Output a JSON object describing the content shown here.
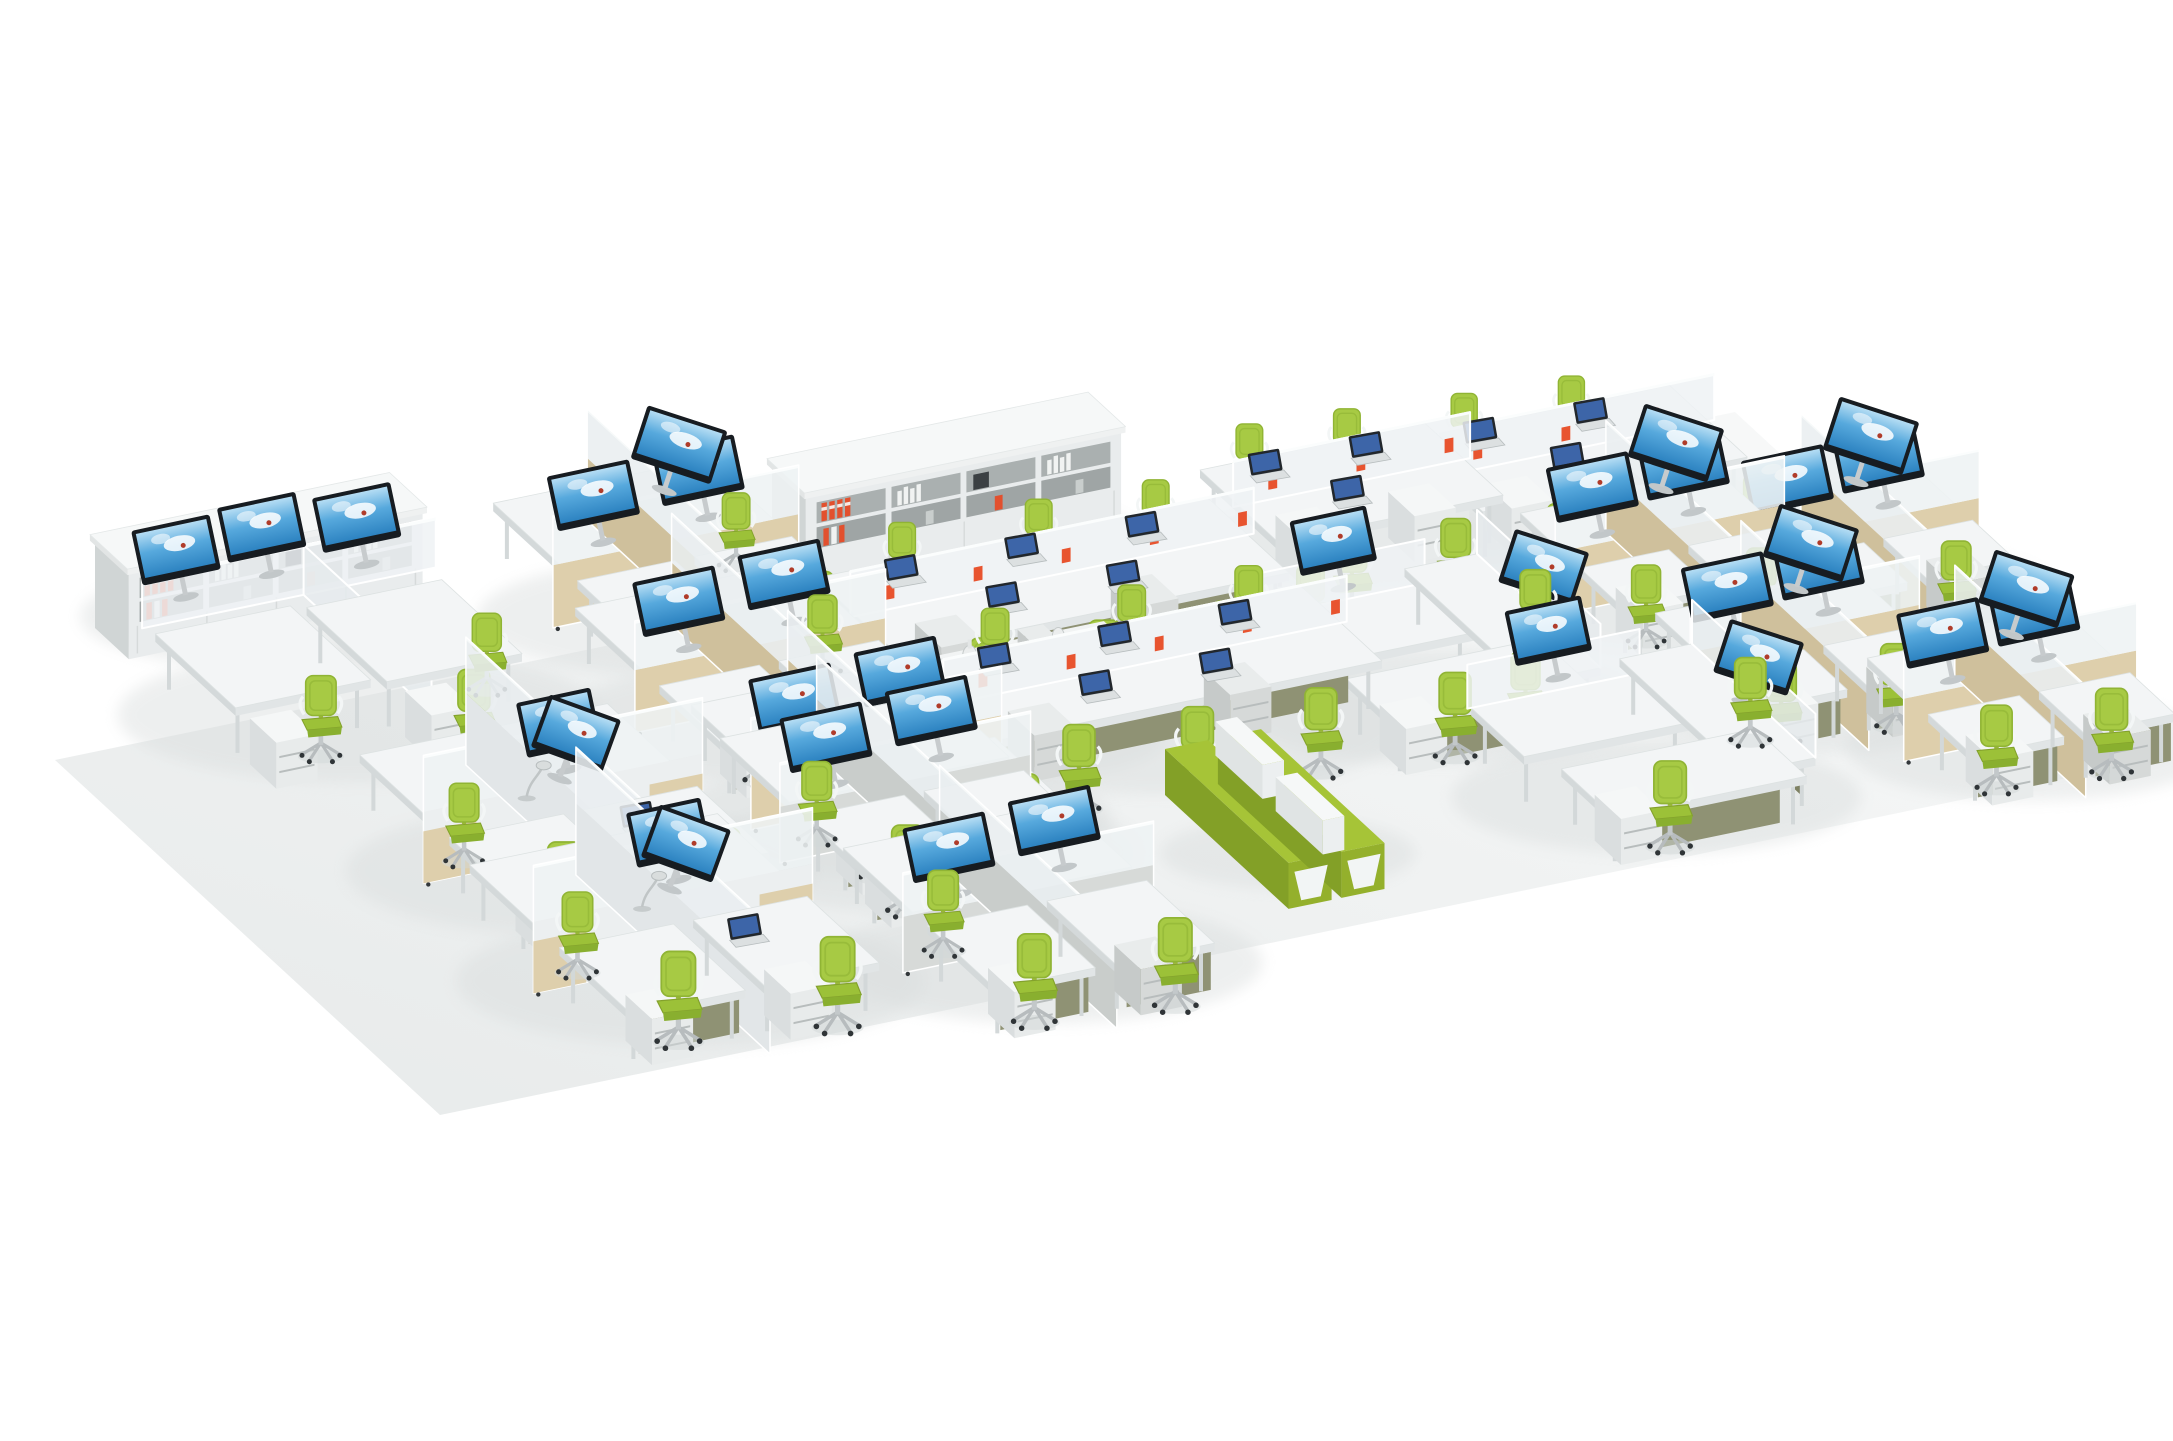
{
  "meta": {
    "title": "Open plan office furniture layout — isometric product render",
    "scene_type": "3d-furniture-render",
    "visible_text": ""
  },
  "palette": {
    "background": "#ffffff",
    "floor_light": "#f9fafa",
    "floor_dark": "#e7eaea",
    "shadow": "#d9dddd",
    "desk_top": "#f3f5f6",
    "desk_front": "#e1e5e6",
    "desk_side": "#d4d9da",
    "panel_frost": "#eef2f4",
    "panel_tan": "#decfac",
    "panel_tan_dark": "#cfc09c",
    "panel_concrete": "#d7dad8",
    "modesty_khaki": "#8f9274",
    "chair_green": "#a7ca44",
    "chair_green_dark": "#88ae2e",
    "monitor_bezel": "#171c21",
    "screen_sky_top": "#b5ddf4",
    "screen_sky_mid": "#57a9dd",
    "screen_sky_bottom": "#2d83c1",
    "binder_red": "#e2502e",
    "accent_orange": "#e8542f",
    "bench_green": "#a6c437"
  },
  "scene": {
    "floor": {
      "corners": [
        [
          55,
          760
        ],
        [
          1735,
          412
        ],
        [
          2120,
          767
        ],
        [
          440,
          1115
        ]
      ],
      "gradient": [
        "#f9fafa",
        "#e7eaea"
      ]
    },
    "axes": {
      "u": [
        0.9792,
        -0.2028
      ],
      "v": [
        0.7352,
        0.6779
      ]
    },
    "items": [
      {
        "id": "wall-shelf-left",
        "type": "shelf",
        "label": "bookcase wall with red binders",
        "anchor": [
          95,
          628
        ],
        "lu": 300,
        "lv": 46,
        "h": 92,
        "segments": 4
      },
      {
        "id": "corner-workstations-left",
        "type": "cornerquad",
        "label": "corner workstation pod with monitors",
        "anchor": [
          120,
          660
        ],
        "lu": 300,
        "lv": 210,
        "chairs": [
          [
            85,
            160,
            1.05
          ],
          [
            215,
            195,
            1.1
          ],
          [
            283,
            122,
            1.0
          ]
        ],
        "monitors": [
          [
            58,
            34,
            -12,
            94
          ],
          [
            150,
            28,
            -12,
            94
          ],
          [
            238,
            40,
            -12,
            94
          ]
        ]
      },
      {
        "id": "workstation-quad-a",
        "type": "quad",
        "variant": "tan",
        "label": "4-person cubicle cluster",
        "anchor": [
          478,
          550
        ],
        "lu": 235,
        "lv": 225,
        "chairs": [
          [
            62,
            192,
            1.05
          ],
          [
            192,
            206,
            1.1
          ],
          [
            205,
            78,
            0.95
          ]
        ],
        "monitors": [
          [
            56,
            118,
            -12,
            96
          ],
          [
            166,
            114,
            -12,
            96
          ],
          [
            122,
            58,
            18,
            96
          ]
        ]
      },
      {
        "id": "wall-shelf-center",
        "type": "shelf",
        "label": "bookcase wall with red binders",
        "anchor": [
          772,
          556
        ],
        "lu": 322,
        "lv": 46,
        "h": 96,
        "segments": 4
      },
      {
        "id": "bench-row-1",
        "type": "bench",
        "variant": "khaki",
        "label": "shared bench desk row with laptops",
        "anchor": [
          815,
          630
        ],
        "lu": 400,
        "lv": 112,
        "chairs": [
          [
            110,
            -28,
            0.92
          ],
          [
            245,
            -22,
            0.92
          ],
          [
            360,
            -16,
            0.92
          ],
          [
            65,
            146,
            1.08
          ],
          [
            180,
            154,
            1.08
          ],
          [
            300,
            162,
            1.08
          ]
        ],
        "laptops": [
          [
            80,
            26
          ],
          [
            200,
            30
          ],
          [
            320,
            34
          ],
          [
            140,
            84
          ],
          [
            260,
            88
          ]
        ]
      },
      {
        "id": "bench-row-2",
        "type": "bench",
        "variant": "khaki",
        "label": "shared bench desk row with laptops",
        "anchor": [
          908,
          718
        ],
        "lu": 400,
        "lv": 112,
        "chairs": [
          [
            110,
            -28,
            0.95
          ],
          [
            245,
            -22,
            0.95
          ],
          [
            360,
            -16,
            0.95
          ],
          [
            65,
            146,
            1.1
          ],
          [
            180,
            154,
            1.1
          ],
          [
            300,
            162,
            1.1
          ]
        ],
        "laptops": [
          [
            80,
            26
          ],
          [
            200,
            30
          ],
          [
            320,
            34
          ],
          [
            140,
            84
          ],
          [
            260,
            88
          ]
        ]
      },
      {
        "id": "bench-row-3",
        "type": "bench",
        "variant": "white",
        "label": "white bench desk group",
        "anchor": [
          1200,
          522
        ],
        "lu": 230,
        "lv": 106,
        "chairs": [
          [
            70,
            -26,
            0.92
          ],
          [
            165,
            -20,
            0.92
          ],
          [
            50,
            140,
            1.02
          ],
          [
            150,
            148,
            1.02
          ]
        ],
        "laptops": [
          [
            60,
            24
          ],
          [
            160,
            28
          ],
          [
            105,
            76
          ]
        ]
      },
      {
        "id": "bench-row-4",
        "type": "bench",
        "variant": "white",
        "label": "white bench desk group",
        "anchor": [
          1405,
          492
        ],
        "lu": 270,
        "lv": 106,
        "chairs": [
          [
            80,
            -26,
            0.9
          ],
          [
            185,
            -20,
            0.9
          ],
          [
            55,
            140,
            1.0
          ],
          [
            160,
            148,
            1.0
          ],
          [
            245,
            154,
            1.0
          ]
        ],
        "laptops": [
          [
            70,
            24
          ],
          [
            180,
            28
          ],
          [
            120,
            76
          ]
        ]
      },
      {
        "id": "cubicle-quad-right-1",
        "type": "quad",
        "variant": "tan",
        "label": "cubicle pair with maple panels",
        "anchor": [
          1505,
          560
        ],
        "lu": 218,
        "lv": 158,
        "chairs": [
          [
            48,
            128,
            1.0
          ],
          [
            158,
            138,
            1.02
          ],
          [
            180,
            54,
            0.92
          ]
        ],
        "monitors": [
          [
            52,
            84,
            -12,
            92
          ],
          [
            148,
            80,
            -12,
            92
          ],
          [
            112,
            32,
            18,
            92
          ]
        ]
      },
      {
        "id": "cubicle-quad-right-2",
        "type": "quad",
        "variant": "tan",
        "label": "cubicle pair with maple panels",
        "anchor": [
          1700,
          553
        ],
        "lu": 218,
        "lv": 158,
        "chairs": [
          [
            48,
            128,
            1.0
          ],
          [
            158,
            138,
            1.02
          ],
          [
            180,
            54,
            0.92
          ]
        ],
        "monitors": [
          [
            52,
            84,
            -12,
            92
          ],
          [
            148,
            80,
            -12,
            92
          ],
          [
            112,
            32,
            18,
            92
          ]
        ]
      },
      {
        "id": "cubicle-quad-right-3",
        "type": "quad",
        "variant": "tan",
        "label": "cubicle pair with maple panels",
        "anchor": [
          1640,
          660
        ],
        "lu": 218,
        "lv": 158,
        "chairs": [
          [
            48,
            128,
            1.05
          ],
          [
            158,
            138,
            1.08
          ],
          [
            180,
            54,
            0.95
          ]
        ],
        "monitors": [
          [
            52,
            84,
            -12,
            92
          ],
          [
            148,
            80,
            -12,
            92
          ],
          [
            112,
            32,
            18,
            92
          ]
        ]
      },
      {
        "id": "cubicle-quad-right-4",
        "type": "quad",
        "variant": "tan",
        "label": "cubicle pair with maple panels",
        "anchor": [
          1852,
          705
        ],
        "lu": 222,
        "lv": 162,
        "chairs": [
          [
            50,
            130,
            1.08
          ],
          [
            160,
            140,
            1.1
          ],
          [
            182,
            56,
            0.98
          ]
        ],
        "monitors": [
          [
            54,
            86,
            -12,
            92
          ],
          [
            150,
            82,
            -12,
            92
          ],
          [
            114,
            34,
            18,
            92
          ]
        ]
      },
      {
        "id": "y-cluster-1",
        "type": "ycluster",
        "label": "120-degree 3-way workstation cluster",
        "anchor": [
          1240,
          655
        ],
        "lu": 242,
        "lv": 188,
        "chairs": [
          [
            78,
            -8,
            0.95
          ],
          [
            255,
            62,
            1.05
          ],
          [
            92,
            170,
            1.1
          ]
        ],
        "monitors": [
          [
            100,
            26,
            -12,
            84
          ],
          [
            205,
            92,
            18,
            84
          ]
        ]
      },
      {
        "id": "y-cluster-2",
        "type": "ycluster",
        "label": "120-degree 3-way workstation cluster",
        "anchor": [
          1455,
          745
        ],
        "lu": 242,
        "lv": 188,
        "chairs": [
          [
            78,
            -8,
            1.0
          ],
          [
            255,
            62,
            1.08
          ],
          [
            92,
            170,
            1.12
          ]
        ],
        "monitors": [
          [
            100,
            26,
            -12,
            84
          ],
          [
            205,
            92,
            18,
            84
          ]
        ]
      },
      {
        "id": "credenza-center",
        "type": "credenza",
        "label": "low storage credenza with binders and vases",
        "anchor": [
          929,
          737
        ],
        "lu": 178,
        "lv": 52,
        "h": 78
      },
      {
        "id": "workstation-quad-b",
        "type": "quad",
        "variant": "tan",
        "label": "4-person cubicle cluster",
        "anchor": [
          560,
          655
        ],
        "lu": 240,
        "lv": 225,
        "chairs": [
          [
            62,
            196,
            1.1
          ],
          [
            196,
            210,
            1.1
          ],
          [
            208,
            80,
            1.0
          ]
        ],
        "monitors": [
          [
            58,
            120,
            -12,
            96
          ],
          [
            170,
            114,
            -12,
            96
          ]
        ]
      },
      {
        "id": "workstation-quad-c",
        "type": "quad",
        "variant": "tan",
        "label": "4-person cubicle cluster",
        "anchor": [
          676,
          752
        ],
        "lu": 240,
        "lv": 225,
        "chairs": [
          [
            62,
            196,
            1.12
          ],
          [
            196,
            210,
            1.12
          ],
          [
            208,
            80,
            1.0
          ]
        ],
        "monitors": [
          [
            58,
            120,
            -12,
            96
          ],
          [
            170,
            114,
            -12,
            96
          ]
        ]
      },
      {
        "id": "x-cluster-1",
        "type": "xquad",
        "label": "X-partition 4-person cluster with lamp",
        "anchor": [
          345,
          800
        ],
        "lu": 265,
        "lv": 240,
        "chairs": [
          [
            70,
            205,
            1.15
          ],
          [
            215,
            228,
            1.15
          ],
          [
            48,
            98,
            1.02
          ]
        ],
        "monitors": [
          [
            150,
            130,
            -12,
            108
          ],
          [
            96,
            122,
            20,
            108
          ]
        ],
        "lamps": [
          [
            106,
            106
          ]
        ],
        "laptops": [
          [
            182,
            170
          ]
        ]
      },
      {
        "id": "x-cluster-2",
        "type": "xquad",
        "label": "X-partition 4-person cluster with lamp",
        "anchor": [
          455,
          910
        ],
        "lu": 265,
        "lv": 240,
        "chairs": [
          [
            72,
            208,
            1.18
          ],
          [
            218,
            230,
            1.18
          ],
          [
            50,
            100,
            1.05
          ]
        ],
        "monitors": [
          [
            150,
            130,
            -12,
            108
          ],
          [
            96,
            122,
            20,
            108
          ]
        ],
        "lamps": [
          [
            110,
            108
          ]
        ],
        "laptops": [
          [
            178,
            172
          ]
        ]
      },
      {
        "id": "workstation-quad-d",
        "type": "quad",
        "variant": "low",
        "label": "open quad with low screens",
        "anchor": [
          705,
          785
        ],
        "lu": 240,
        "lv": 225,
        "chairs": [
          [
            60,
            196,
            1.12
          ],
          [
            192,
            212,
            1.12
          ],
          [
            48,
            88,
            1.02
          ]
        ],
        "monitors": [
          [
            60,
            118,
            -12,
            88
          ],
          [
            172,
            112,
            -12,
            88
          ]
        ]
      },
      {
        "id": "workstation-quad-e",
        "type": "quad",
        "variant": "low",
        "label": "open quad with low screens",
        "anchor": [
          828,
          895
        ],
        "lu": 240,
        "lv": 225,
        "chairs": [
          [
            62,
            198,
            1.15
          ],
          [
            194,
            214,
            1.15
          ],
          [
            50,
            90,
            1.05
          ]
        ],
        "monitors": [
          [
            60,
            118,
            -12,
            88
          ],
          [
            172,
            112,
            -12,
            88
          ]
        ]
      },
      {
        "id": "lounge-bench",
        "type": "gbench",
        "label": "lime green lounge benches with white backrests",
        "anchor": [
          1165,
          795
        ],
        "lu": 100,
        "lv": 168,
        "h": 46
      }
    ]
  }
}
